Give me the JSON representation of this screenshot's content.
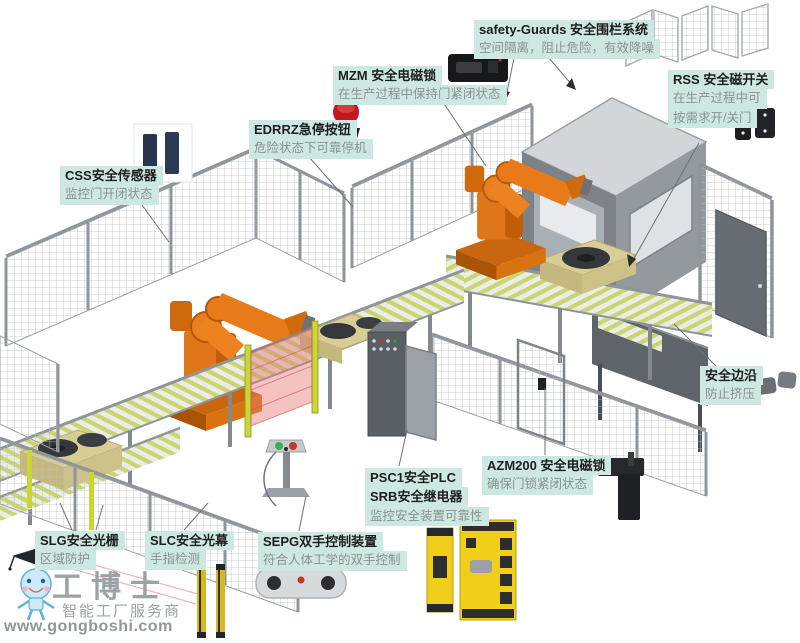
{
  "colors": {
    "label_bg": "#cde8e2",
    "label_title": "#1e1e1e",
    "label_subtitle": "#8b918e",
    "robot_orange": "#e0761a",
    "fence_gray": "#9aa0a5",
    "roller_green": "#c8d571",
    "machine_gray": "#7c8287",
    "safety_yellow": "#f0cf1a",
    "estop_red": "#c3161f",
    "screen_pink": "#e3807f"
  },
  "labels": [
    {
      "id": "safety_guards",
      "title": "safety-Guards 安全围栏系统",
      "subtitle": "空间隔离，阻止危险，有效降噪"
    },
    {
      "id": "mzm",
      "title": "MZM 安全电磁锁",
      "subtitle": "在生产过程中保持门紧闭状态"
    },
    {
      "id": "edrrz",
      "title": "EDRRZ急停按钮",
      "subtitle": "危险状态下可靠停机"
    },
    {
      "id": "css",
      "title": "CSS安全传感器",
      "subtitle": "监控门开闭状态"
    },
    {
      "id": "rss",
      "title": "RSS 安全磁开关",
      "subtitle": "在生产过程中可",
      "subtitle2": "按需求开/关门"
    },
    {
      "id": "safety_edge",
      "title": "安全边沿",
      "subtitle": "防止挤压"
    },
    {
      "id": "azm200",
      "title": "AZM200 安全电磁锁",
      "subtitle": "确保门锁紧闭状态"
    },
    {
      "id": "psc1_srb",
      "title": "PSC1安全PLC",
      "title2": "SRB安全继电器",
      "subtitle": "监控安全装置可靠性"
    },
    {
      "id": "sepg",
      "title": "SEPG双手控制装置",
      "subtitle": "符合人体工学的双手控制"
    },
    {
      "id": "slg",
      "title": "SLG安全光栅",
      "subtitle": "区域防护"
    },
    {
      "id": "slc",
      "title": "SLC安全光幕",
      "subtitle": "手指检测"
    }
  ],
  "device_icons": {
    "mzm": "solenoid-interlock",
    "edrrz": "emergency-stop-button",
    "css": "safety-sensor-pair",
    "rss": "magnetic-safety-switch-pair",
    "safety_edge": "pressure-edge-profiles",
    "azm200": "door-solenoid-lock",
    "psc1_srb": "safety-plc-and-relay-modules",
    "sepg": "two-hand-control-console",
    "slc": "light-curtain-bars"
  },
  "watermark": {
    "brand": "工博士",
    "tagline": "智能工厂服务商",
    "url": "www.gongboshi.com"
  }
}
